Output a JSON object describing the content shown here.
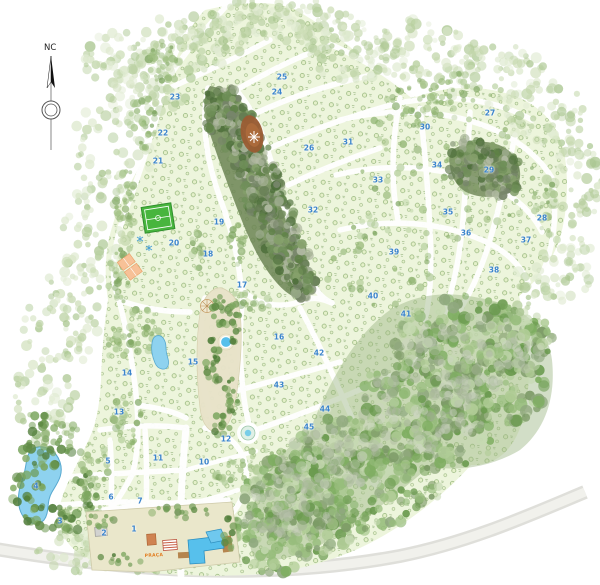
{
  "map": {
    "compass": {
      "top_label": "NC",
      "center_letter": "N"
    },
    "plaza_label": "PRAÇA",
    "colors": {
      "section_number": "#3c85cc",
      "water": "#8ed2ef",
      "pool": "#57c0ec",
      "field_green": "#48b53e",
      "clearing_brown": "#9a5c33",
      "lot_fill": "#edf5dc",
      "plaza_text": "#e27d1f",
      "court_orange": "#f7c197"
    },
    "sections": [
      {
        "n": "1",
        "x": 134,
        "y": 529
      },
      {
        "n": "2",
        "x": 104,
        "y": 533
      },
      {
        "n": "3",
        "x": 60,
        "y": 521
      },
      {
        "n": "4",
        "x": 36,
        "y": 486
      },
      {
        "n": "5",
        "x": 108,
        "y": 461
      },
      {
        "n": "6",
        "x": 111,
        "y": 497
      },
      {
        "n": "7",
        "x": 140,
        "y": 501
      },
      {
        "n": "10",
        "x": 204,
        "y": 462
      },
      {
        "n": "11",
        "x": 158,
        "y": 458
      },
      {
        "n": "12",
        "x": 226,
        "y": 439
      },
      {
        "n": "13",
        "x": 119,
        "y": 412
      },
      {
        "n": "14",
        "x": 127,
        "y": 373
      },
      {
        "n": "15",
        "x": 193,
        "y": 362
      },
      {
        "n": "16",
        "x": 279,
        "y": 337
      },
      {
        "n": "17",
        "x": 242,
        "y": 285
      },
      {
        "n": "18",
        "x": 208,
        "y": 254
      },
      {
        "n": "19",
        "x": 219,
        "y": 222
      },
      {
        "n": "20",
        "x": 174,
        "y": 243
      },
      {
        "n": "21",
        "x": 158,
        "y": 161
      },
      {
        "n": "22",
        "x": 163,
        "y": 133
      },
      {
        "n": "23",
        "x": 175,
        "y": 97
      },
      {
        "n": "24",
        "x": 277,
        "y": 92
      },
      {
        "n": "25",
        "x": 282,
        "y": 77
      },
      {
        "n": "26",
        "x": 309,
        "y": 148
      },
      {
        "n": "27",
        "x": 490,
        "y": 113
      },
      {
        "n": "28",
        "x": 542,
        "y": 218
      },
      {
        "n": "29",
        "x": 489,
        "y": 170
      },
      {
        "n": "30",
        "x": 425,
        "y": 127
      },
      {
        "n": "31",
        "x": 348,
        "y": 142
      },
      {
        "n": "32",
        "x": 313,
        "y": 210
      },
      {
        "n": "33",
        "x": 378,
        "y": 180
      },
      {
        "n": "34",
        "x": 437,
        "y": 165
      },
      {
        "n": "35",
        "x": 448,
        "y": 212
      },
      {
        "n": "36",
        "x": 466,
        "y": 233
      },
      {
        "n": "37",
        "x": 526,
        "y": 240
      },
      {
        "n": "38",
        "x": 494,
        "y": 270
      },
      {
        "n": "39",
        "x": 394,
        "y": 252
      },
      {
        "n": "40",
        "x": 373,
        "y": 296
      },
      {
        "n": "41",
        "x": 406,
        "y": 314
      },
      {
        "n": "42",
        "x": 319,
        "y": 353
      },
      {
        "n": "43",
        "x": 279,
        "y": 385
      },
      {
        "n": "44",
        "x": 325,
        "y": 409
      },
      {
        "n": "45",
        "x": 309,
        "y": 427
      }
    ]
  }
}
